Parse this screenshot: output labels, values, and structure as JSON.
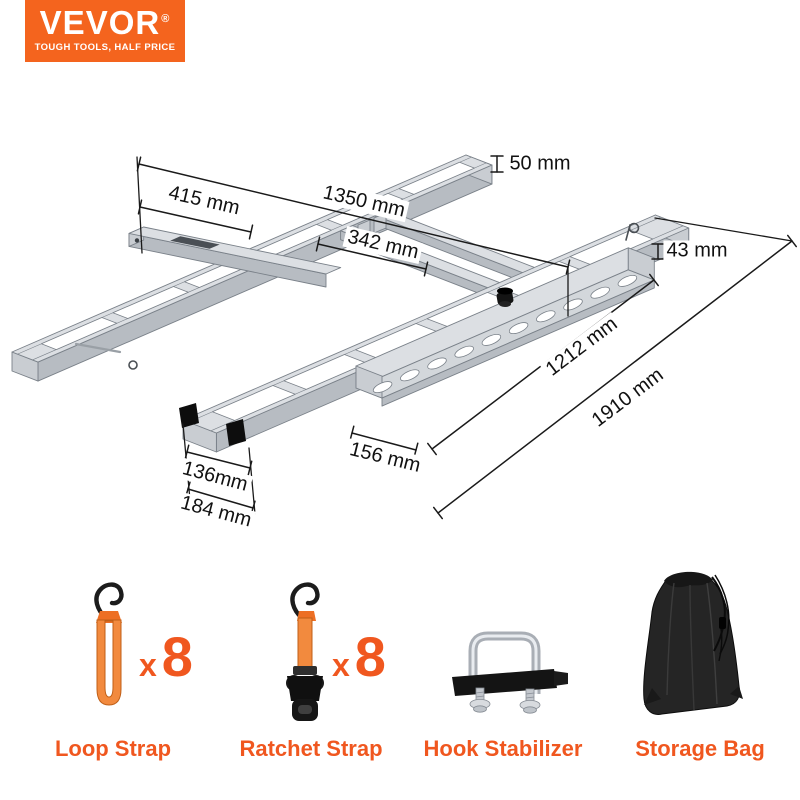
{
  "brand": {
    "logo_text": "VEVOR",
    "logo_registered": "®",
    "tagline": "TOUGH TOOLS, HALF PRICE"
  },
  "colors": {
    "brand_orange": "#F4641E",
    "accent_text_orange": "#F0571F",
    "dim_line": "#1a1a1a",
    "dim_text": "#111111",
    "metal_top": "#dcdfe3",
    "metal_side": "#b7bcc2",
    "metal_end": "#c9cdd2",
    "metal_line": "#7a8189",
    "strap_orange": "#F28A3E",
    "black_part": "#141414"
  },
  "diagram": {
    "dimensions": [
      {
        "label": "50 mm",
        "x": 540,
        "y": 164,
        "rot": 0
      },
      {
        "label": "415 mm",
        "x": 204,
        "y": 201,
        "rot": 13
      },
      {
        "label": "1350 mm",
        "x": 364,
        "y": 202,
        "rot": 13
      },
      {
        "label": "342 mm",
        "x": 383,
        "y": 245,
        "rot": 13
      },
      {
        "label": "43 mm",
        "x": 697,
        "y": 251,
        "rot": 0
      },
      {
        "label": "1212 mm",
        "x": 582,
        "y": 347,
        "rot": -37
      },
      {
        "label": "1910 mm",
        "x": 628,
        "y": 398,
        "rot": -37
      },
      {
        "label": "156 mm",
        "x": 385,
        "y": 458,
        "rot": 14
      },
      {
        "label": "136mm",
        "x": 215,
        "y": 477,
        "rot": 15
      },
      {
        "label": "184 mm",
        "x": 216,
        "y": 512,
        "rot": 15
      }
    ]
  },
  "accessories": {
    "items": [
      {
        "name": "Loop Strap",
        "multiplier": "x",
        "count": "8"
      },
      {
        "name": "Ratchet Strap",
        "multiplier": "x",
        "count": "8"
      },
      {
        "name": "Hook Stabilizer",
        "multiplier": "",
        "count": ""
      },
      {
        "name": "Storage Bag",
        "multiplier": "",
        "count": ""
      }
    ]
  }
}
